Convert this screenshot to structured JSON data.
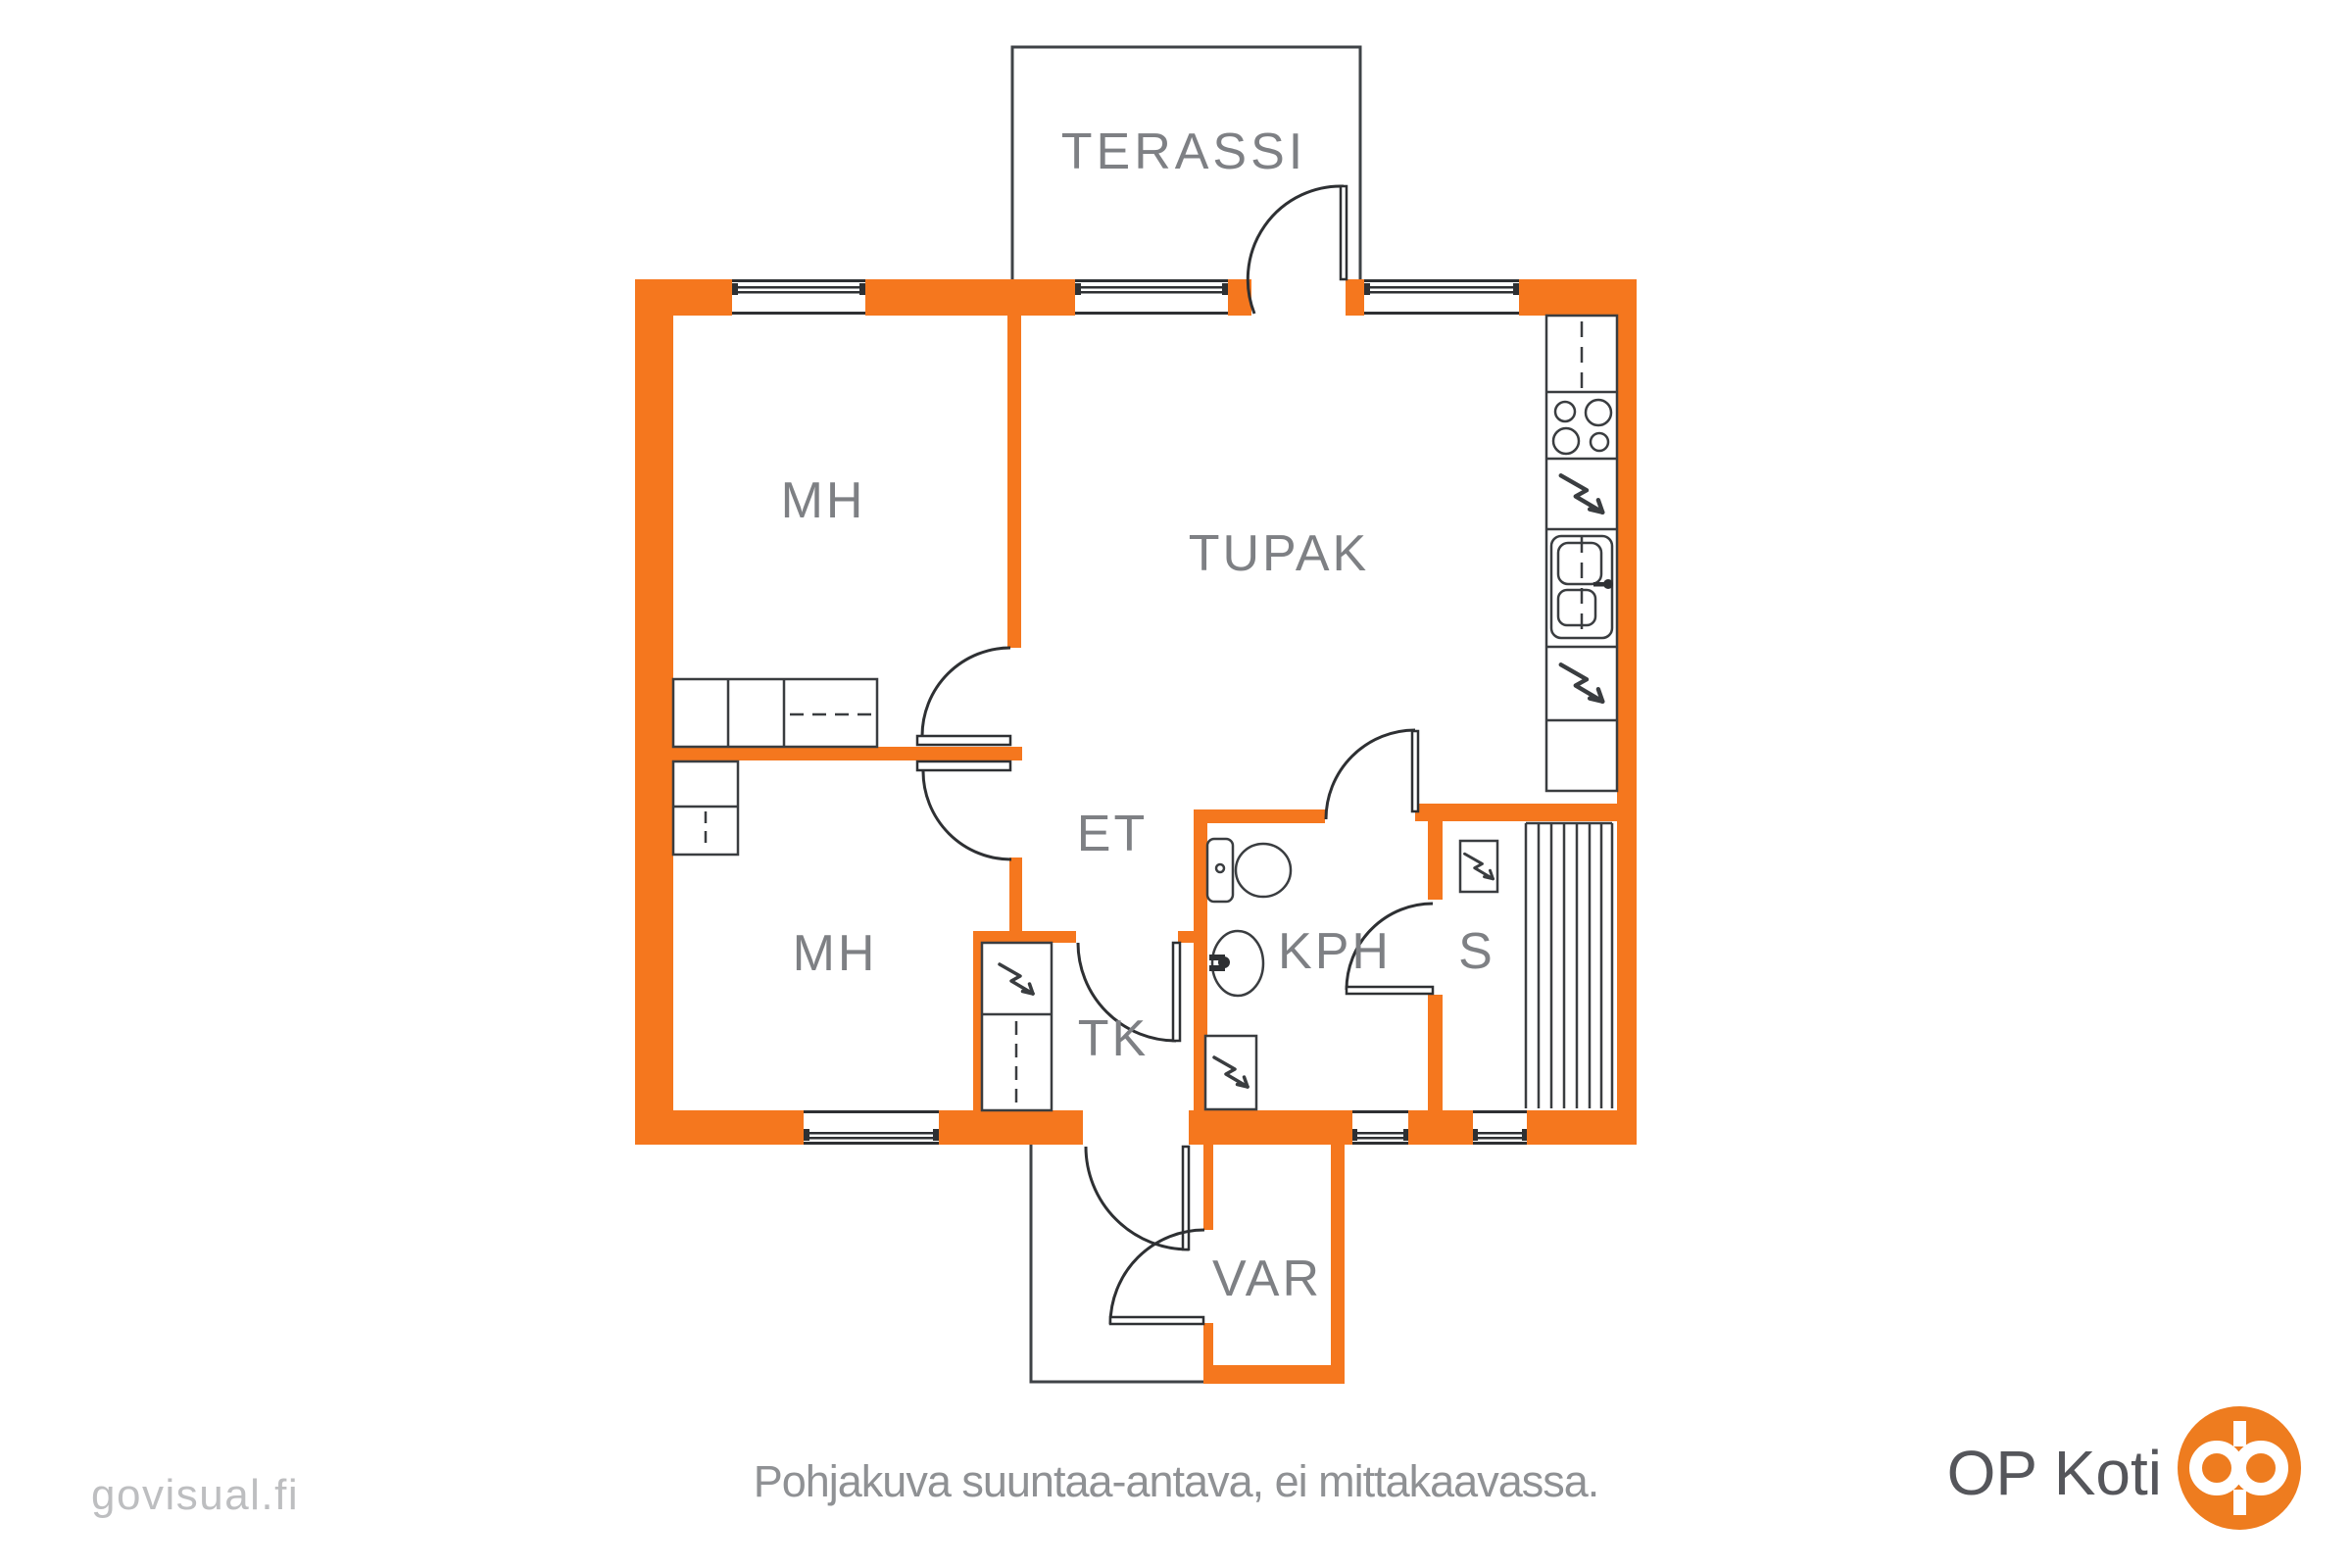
{
  "rooms": {
    "terassi": "TERASSI",
    "mh_upper": "MH",
    "tupak": "TUPAK",
    "et": "ET",
    "mh_lower": "MH",
    "tk": "TK",
    "kph": "KPH",
    "s": "S",
    "var": "VAR"
  },
  "footer": {
    "caption": "Pohjakuva suuntaa-antava, ei mittakaavassa.",
    "watermark": "govisual.fi",
    "brand_name": "OP Koti"
  },
  "colors": {
    "wall": "#f5771e",
    "line": "#2e3033",
    "furniture_line": "#3a3d40",
    "outline": "#3f4347",
    "room_label": "#7e8084",
    "caption": "#8f9194",
    "watermark": "#bdbec0",
    "brand_text": "#55565b",
    "brand_orange": "#ee7c1f",
    "background": "#ffffff"
  }
}
